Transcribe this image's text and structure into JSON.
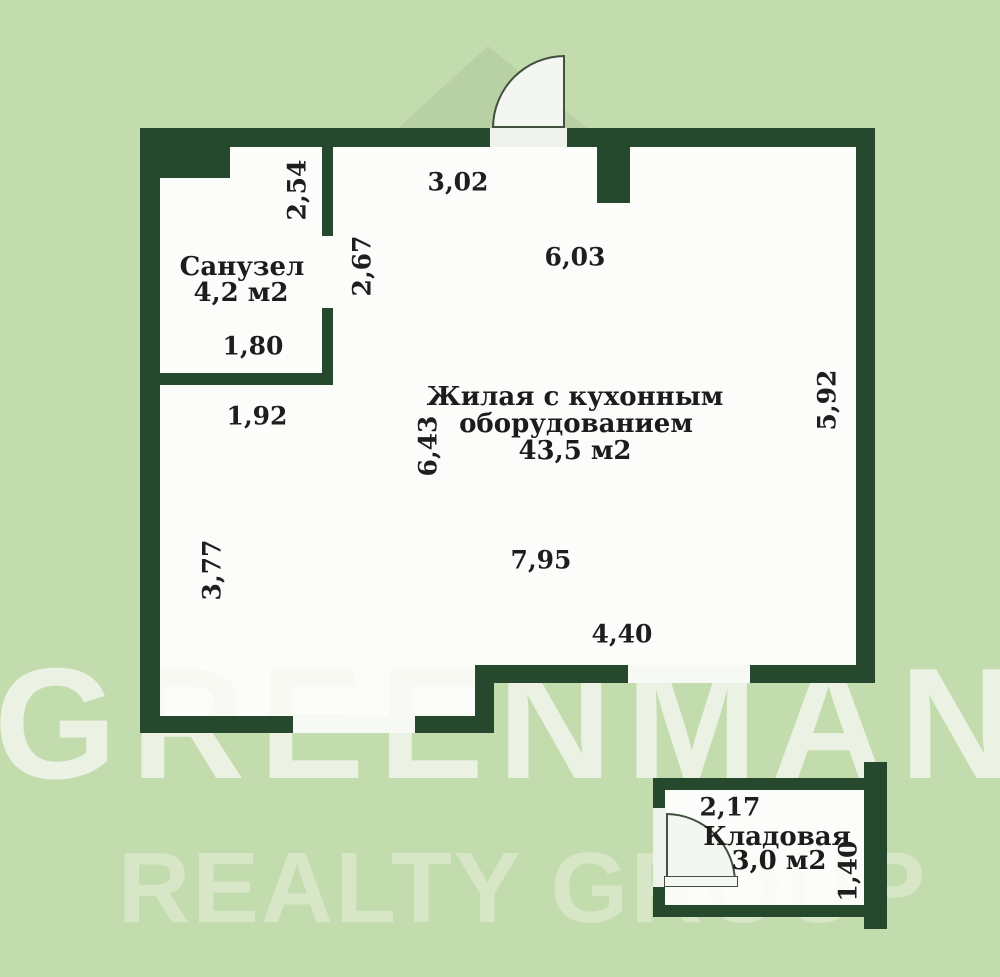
{
  "watermark": {
    "line1": "GREENMAN",
    "line2": "REALTY GROUP"
  },
  "rooms": {
    "bathroom": {
      "name": "Санузел",
      "area": "4,2 м2"
    },
    "living": {
      "name_line1": "Жилая с кухонным",
      "name_line2": "оборудованием",
      "area": "43,5 м2"
    },
    "storage": {
      "name": "Кладовая",
      "area": "3,0 м2"
    }
  },
  "dimensions": {
    "bathroom_entry_height": "2,54",
    "entry_top_width": "3,02",
    "living_top_width": "6,03",
    "corridor_height": "2,67",
    "bathroom_width": "1,80",
    "below_bathroom_width": "1,92",
    "living_height_left": "6,43",
    "living_height_right": "5,92",
    "left_wall_height": "3,77",
    "living_width": "7,95",
    "living_bottom_width": "4,40",
    "storage_width": "2,17",
    "storage_height": "1,40"
  },
  "colors": {
    "background": "#c3dcae",
    "wall": "#26492d",
    "floor": "#fcfdfa",
    "text": "#1e1e1e",
    "watermark": "#f5f8f0"
  }
}
